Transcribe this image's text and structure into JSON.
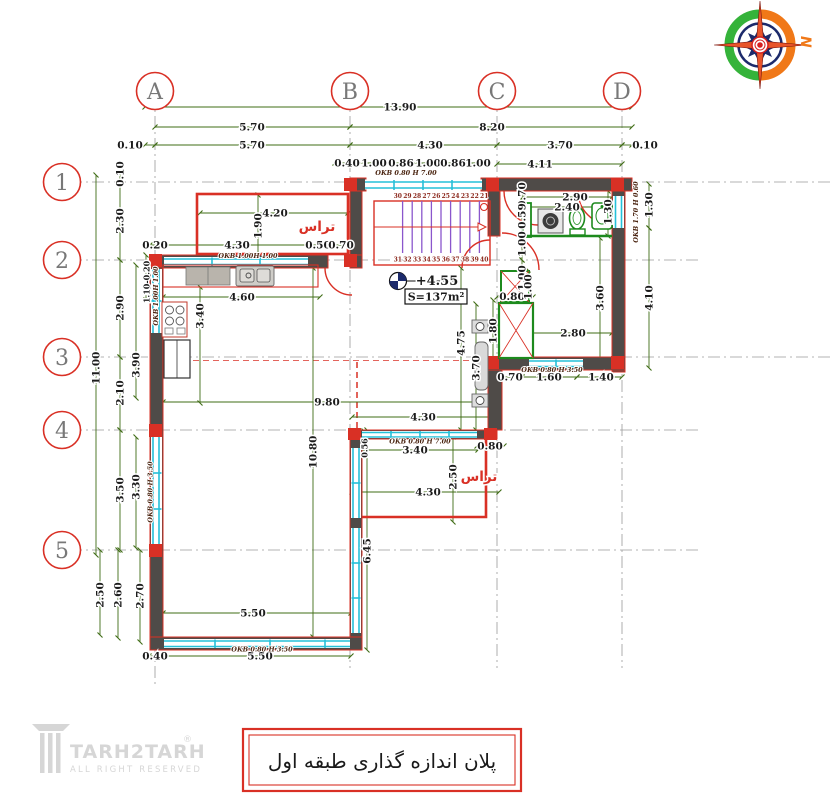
{
  "title_box": {
    "text": "پلان اندازه گذاری طبقه اول"
  },
  "logo": {
    "name": "TARH2TARH",
    "registered": "®",
    "tagline": "ALL RIGHT RESERVED"
  },
  "compass": {
    "label": "N"
  },
  "grid": {
    "columns": [
      "A",
      "B",
      "C",
      "D"
    ],
    "rows": [
      "1",
      "2",
      "3",
      "4",
      "5"
    ]
  },
  "colors": {
    "accent_red": "#d93025",
    "wall_gray": "#4f4b48",
    "dim_green": "#3f6c15",
    "window_cyan": "#25c0d8",
    "stair_purple": "#8a56cc",
    "stair_number": "#8c2a1e",
    "fixture_green": "#1d8a1d",
    "ink": "#1c1c1c",
    "okb_brown": "#4a2410",
    "grid_gray": "#9a9a9a",
    "logo_gray": "#d6d6d6",
    "compass_green": "#35b33a",
    "compass_orange": "#f07818",
    "compass_navy": "#1c2a6b",
    "compass_red": "#d62020"
  },
  "labels": [
    {
      "id": "dim-overall-width",
      "text": "13.90",
      "x": 400,
      "y": 110.5
    },
    {
      "id": "dim-span-ab",
      "text": "5.70",
      "x": 252,
      "y": 130.5
    },
    {
      "id": "dim-span-bd",
      "text": "8.20",
      "x": 492,
      "y": 130.5
    },
    {
      "id": "dim-edge-left",
      "text": "0.10",
      "x": 130,
      "y": 148.5
    },
    {
      "id": "dim-ab",
      "text": "5.70",
      "x": 252,
      "y": 148.5
    },
    {
      "id": "dim-bc",
      "text": "4.30",
      "x": 430,
      "y": 148.5
    },
    {
      "id": "dim-cd",
      "text": "3.70",
      "x": 560,
      "y": 148.5
    },
    {
      "id": "dim-edge-right",
      "text": "0.10",
      "x": 645,
      "y": 148.5
    },
    {
      "id": "dim-stairwin-1",
      "text": "0.40",
      "x": 347,
      "y": 166.5
    },
    {
      "id": "dim-stairwin-2",
      "text": "1.00",
      "x": 374,
      "y": 166.5
    },
    {
      "id": "dim-stairwin-3",
      "text": "0.86",
      "x": 401,
      "y": 166.5
    },
    {
      "id": "dim-stairwin-4",
      "text": "1.00",
      "x": 428,
      "y": 166.5
    },
    {
      "id": "dim-stairwin-5",
      "text": "0.86",
      "x": 453,
      "y": 166.5
    },
    {
      "id": "dim-stairwin-6",
      "text": "1.00",
      "x": 478,
      "y": 166.5
    },
    {
      "id": "dim-top-right",
      "text": "4.11",
      "x": 540,
      "y": 167.5
    },
    {
      "id": "okb-stair-window",
      "text": "OKB 0.80 H 7.00",
      "x": 406,
      "y": 175,
      "cls": "okb"
    },
    {
      "id": "dim-total-height",
      "text": "11.00",
      "x": 99.5,
      "y": 368,
      "rot": -90
    },
    {
      "id": "dim-r1-edge",
      "text": "0.10",
      "x": 123.5,
      "y": 174,
      "rot": -90
    },
    {
      "id": "dim-r12",
      "text": "2.30",
      "x": 123.5,
      "y": 221,
      "rot": -90
    },
    {
      "id": "dim-r23",
      "text": "2.90",
      "x": 123.5,
      "y": 308,
      "rot": -90
    },
    {
      "id": "dim-r34",
      "text": "2.10",
      "x": 123.5,
      "y": 393,
      "rot": -90
    },
    {
      "id": "dim-r45",
      "text": "3.50",
      "x": 123.5,
      "y": 490,
      "rot": -90
    },
    {
      "id": "dim-bl-250",
      "text": "2.50",
      "x": 103.5,
      "y": 595,
      "rot": -90
    },
    {
      "id": "dim-bl-260",
      "text": "2.60",
      "x": 121.5,
      "y": 595,
      "rot": -90
    },
    {
      "id": "dim-bl-270",
      "text": "2.70",
      "x": 143.5,
      "y": 596,
      "rot": -90
    },
    {
      "id": "dim-in-left-390",
      "text": "3.90",
      "x": 139.5,
      "y": 365,
      "rot": -90
    },
    {
      "id": "dim-in-left-330",
      "text": "3.30",
      "x": 139.5,
      "y": 487,
      "rot": -90
    },
    {
      "id": "okb-left-window-low",
      "text": "OKB 0.80 H 3.50",
      "x": 152.5,
      "y": 492,
      "rot": -90,
      "cls": "okb"
    },
    {
      "id": "dim-hall-left",
      "text": "1.10-0.20",
      "x": 149.5,
      "y": 282,
      "rot": -90,
      "cls": "dims"
    },
    {
      "id": "okb-left-window-up",
      "text": "OKB 1.00H 1.00",
      "x": 158,
      "y": 296,
      "rot": -90,
      "cls": "okb"
    },
    {
      "id": "dim-k-020",
      "text": "0.20",
      "x": 155,
      "y": 248.5
    },
    {
      "id": "dim-k-430",
      "text": "4.30",
      "x": 237,
      "y": 248.5
    },
    {
      "id": "dim-k-050",
      "text": "0.50",
      "x": 318,
      "y": 248.5
    },
    {
      "id": "dim-k-070",
      "text": "0.70",
      "x": 341,
      "y": 248.5
    },
    {
      "id": "okb-kitchen-window",
      "text": "OKB 1.00H 1.00",
      "x": 248,
      "y": 258,
      "cls": "okb"
    },
    {
      "id": "dim-k-460",
      "text": "4.60",
      "x": 242,
      "y": 300.5
    },
    {
      "id": "dim-k-340",
      "text": "3.40",
      "x": 203.5,
      "y": 316,
      "rot": -90
    },
    {
      "id": "dim-t1-420",
      "text": "4.20",
      "x": 275,
      "y": 216.5
    },
    {
      "id": "dim-t1-190",
      "text": "1.90",
      "x": 261.5,
      "y": 226,
      "rot": -90
    },
    {
      "id": "label-terrace-top",
      "text": "تراس",
      "x": 317,
      "y": 231,
      "cls": "room"
    },
    {
      "id": "dim-s-070",
      "text": "0.70",
      "x": 525.5,
      "y": 195,
      "rot": -90
    },
    {
      "id": "dim-s-059",
      "text": "0.59",
      "x": 525.5,
      "y": 216,
      "rot": -90
    },
    {
      "id": "dim-s-100a",
      "text": "1.00",
      "x": 525.5,
      "y": 244,
      "rot": -90
    },
    {
      "id": "dim-s-100b",
      "text": "1.00",
      "x": 525.5,
      "y": 278,
      "rot": -90
    },
    {
      "id": "dim-bath-290",
      "text": "2.90",
      "x": 575,
      "y": 200.5
    },
    {
      "id": "dim-bath-240",
      "text": "2.40",
      "x": 567,
      "y": 210.5
    },
    {
      "id": "dim-bath-130-in",
      "text": "1.30",
      "x": 611.5,
      "y": 212,
      "rot": -90
    },
    {
      "id": "dim-right-130",
      "text": "1.30",
      "x": 652.5,
      "y": 205,
      "rot": -90
    },
    {
      "id": "dim-right-410",
      "text": "4.10",
      "x": 652.5,
      "y": 298,
      "rot": -90
    },
    {
      "id": "okb-bath-window",
      "text": "OKB 1.70 H 0.60",
      "x": 638,
      "y": 212,
      "rot": -90,
      "cls": "okb"
    },
    {
      "id": "dim-duct-080",
      "text": "0.80",
      "x": 512,
      "y": 300
    },
    {
      "id": "dim-duct-100",
      "text": "1.00",
      "x": 531.5,
      "y": 287,
      "rot": -90
    },
    {
      "id": "dim-rr-360",
      "text": "3.60",
      "x": 603.5,
      "y": 298,
      "rot": -90
    },
    {
      "id": "dim-rr-280",
      "text": "2.80",
      "x": 573,
      "y": 336.5
    },
    {
      "id": "dim-duct-180",
      "text": "1.80",
      "x": 496.5,
      "y": 331,
      "rot": -90
    },
    {
      "id": "dim-c-475",
      "text": "4.75",
      "x": 464.5,
      "y": 343,
      "rot": -90
    },
    {
      "id": "dim-c-370",
      "text": "3.70",
      "x": 479.5,
      "y": 368,
      "rot": -90
    },
    {
      "id": "dim-rr-070",
      "text": "0.70",
      "x": 510,
      "y": 380.5
    },
    {
      "id": "dim-rr-160",
      "text": "1.60",
      "x": 549,
      "y": 380.5
    },
    {
      "id": "dim-rr-140",
      "text": "1.40",
      "x": 601,
      "y": 380.5
    },
    {
      "id": "okb-rr-window",
      "text": "OKB 0.80 H 3.50",
      "x": 552,
      "y": 372,
      "cls": "okb"
    },
    {
      "id": "dim-c-980",
      "text": "9.80",
      "x": 327,
      "y": 405.5
    },
    {
      "id": "dim-c-1080",
      "text": "10.80",
      "x": 316.5,
      "y": 452,
      "rot": -90
    },
    {
      "id": "dim-c-430a",
      "text": "4.30",
      "x": 423,
      "y": 420.5
    },
    {
      "id": "dim-c-340",
      "text": "3.40",
      "x": 415,
      "y": 453.5
    },
    {
      "id": "dim-c-080",
      "text": "0.80",
      "x": 490,
      "y": 449.5
    },
    {
      "id": "dim-c-056",
      "text": "0.56",
      "x": 367.5,
      "y": 448,
      "rot": -90,
      "cls": "dims"
    },
    {
      "id": "okb-t2-window",
      "text": "OKB 0.80 H 7.00",
      "x": 420,
      "y": 443.5,
      "cls": "okb"
    },
    {
      "id": "dim-t2-250",
      "text": "2.50",
      "x": 456.5,
      "y": 477,
      "rot": -90
    },
    {
      "id": "label-terrace-mid",
      "text": "تراس",
      "x": 479,
      "y": 481,
      "cls": "room"
    },
    {
      "id": "dim-t2-430",
      "text": "4.30",
      "x": 428,
      "y": 495.5
    },
    {
      "id": "dim-c-645",
      "text": "6.45",
      "x": 370.5,
      "y": 551,
      "rot": -90
    },
    {
      "id": "dim-bot-550a",
      "text": "5.50",
      "x": 253,
      "y": 616.5
    },
    {
      "id": "dim-bot-550b",
      "text": "5.50",
      "x": 260,
      "y": 659.5
    },
    {
      "id": "dim-bot-040",
      "text": "0.40",
      "x": 155,
      "y": 659.5
    },
    {
      "id": "okb-bottom-window",
      "text": "OKB 0.80 H 3.50",
      "x": 262,
      "y": 651.5,
      "cls": "okb"
    },
    {
      "id": "label-level",
      "text": "+4.55",
      "x": 437,
      "y": 285,
      "cls": "level"
    },
    {
      "id": "label-area",
      "text": "S=137m²",
      "x": 436,
      "y": 300.5,
      "cls": "area"
    },
    {
      "id": "stair-t-30",
      "text": "30",
      "x": 397.8,
      "y": 198,
      "cls": "stair"
    },
    {
      "id": "stair-t-29",
      "text": "29",
      "x": 407.4,
      "y": 198,
      "cls": "stair"
    },
    {
      "id": "stair-t-28",
      "text": "28",
      "x": 417,
      "y": 198,
      "cls": "stair"
    },
    {
      "id": "stair-t-27",
      "text": "27",
      "x": 426.6,
      "y": 198,
      "cls": "stair"
    },
    {
      "id": "stair-t-26",
      "text": "26",
      "x": 436.2,
      "y": 198,
      "cls": "stair"
    },
    {
      "id": "stair-t-25",
      "text": "25",
      "x": 445.8,
      "y": 198,
      "cls": "stair"
    },
    {
      "id": "stair-t-24",
      "text": "24",
      "x": 455.4,
      "y": 198,
      "cls": "stair"
    },
    {
      "id": "stair-t-23",
      "text": "23",
      "x": 465,
      "y": 198,
      "cls": "stair"
    },
    {
      "id": "stair-t-22",
      "text": "22",
      "x": 474.6,
      "y": 198,
      "cls": "stair"
    },
    {
      "id": "stair-t-21",
      "text": "21",
      "x": 484.2,
      "y": 198,
      "cls": "stair"
    },
    {
      "id": "stair-b-31",
      "text": "31",
      "x": 397.8,
      "y": 261.5,
      "cls": "stair"
    },
    {
      "id": "stair-b-32",
      "text": "32",
      "x": 407.4,
      "y": 261.5,
      "cls": "stair"
    },
    {
      "id": "stair-b-33",
      "text": "33",
      "x": 417,
      "y": 261.5,
      "cls": "stair"
    },
    {
      "id": "stair-b-34",
      "text": "34",
      "x": 426.6,
      "y": 261.5,
      "cls": "stair"
    },
    {
      "id": "stair-b-35",
      "text": "35",
      "x": 436.2,
      "y": 261.5,
      "cls": "stair"
    },
    {
      "id": "stair-b-36",
      "text": "36",
      "x": 445.8,
      "y": 261.5,
      "cls": "stair"
    },
    {
      "id": "stair-b-37",
      "text": "37",
      "x": 455.4,
      "y": 261.5,
      "cls": "stair"
    },
    {
      "id": "stair-b-38",
      "text": "38",
      "x": 465,
      "y": 261.5,
      "cls": "stair"
    },
    {
      "id": "stair-b-39",
      "text": "39",
      "x": 474.6,
      "y": 261.5,
      "cls": "stair"
    },
    {
      "id": "stair-b-40",
      "text": "40",
      "x": 484.2,
      "y": 261.5,
      "cls": "stair"
    }
  ]
}
